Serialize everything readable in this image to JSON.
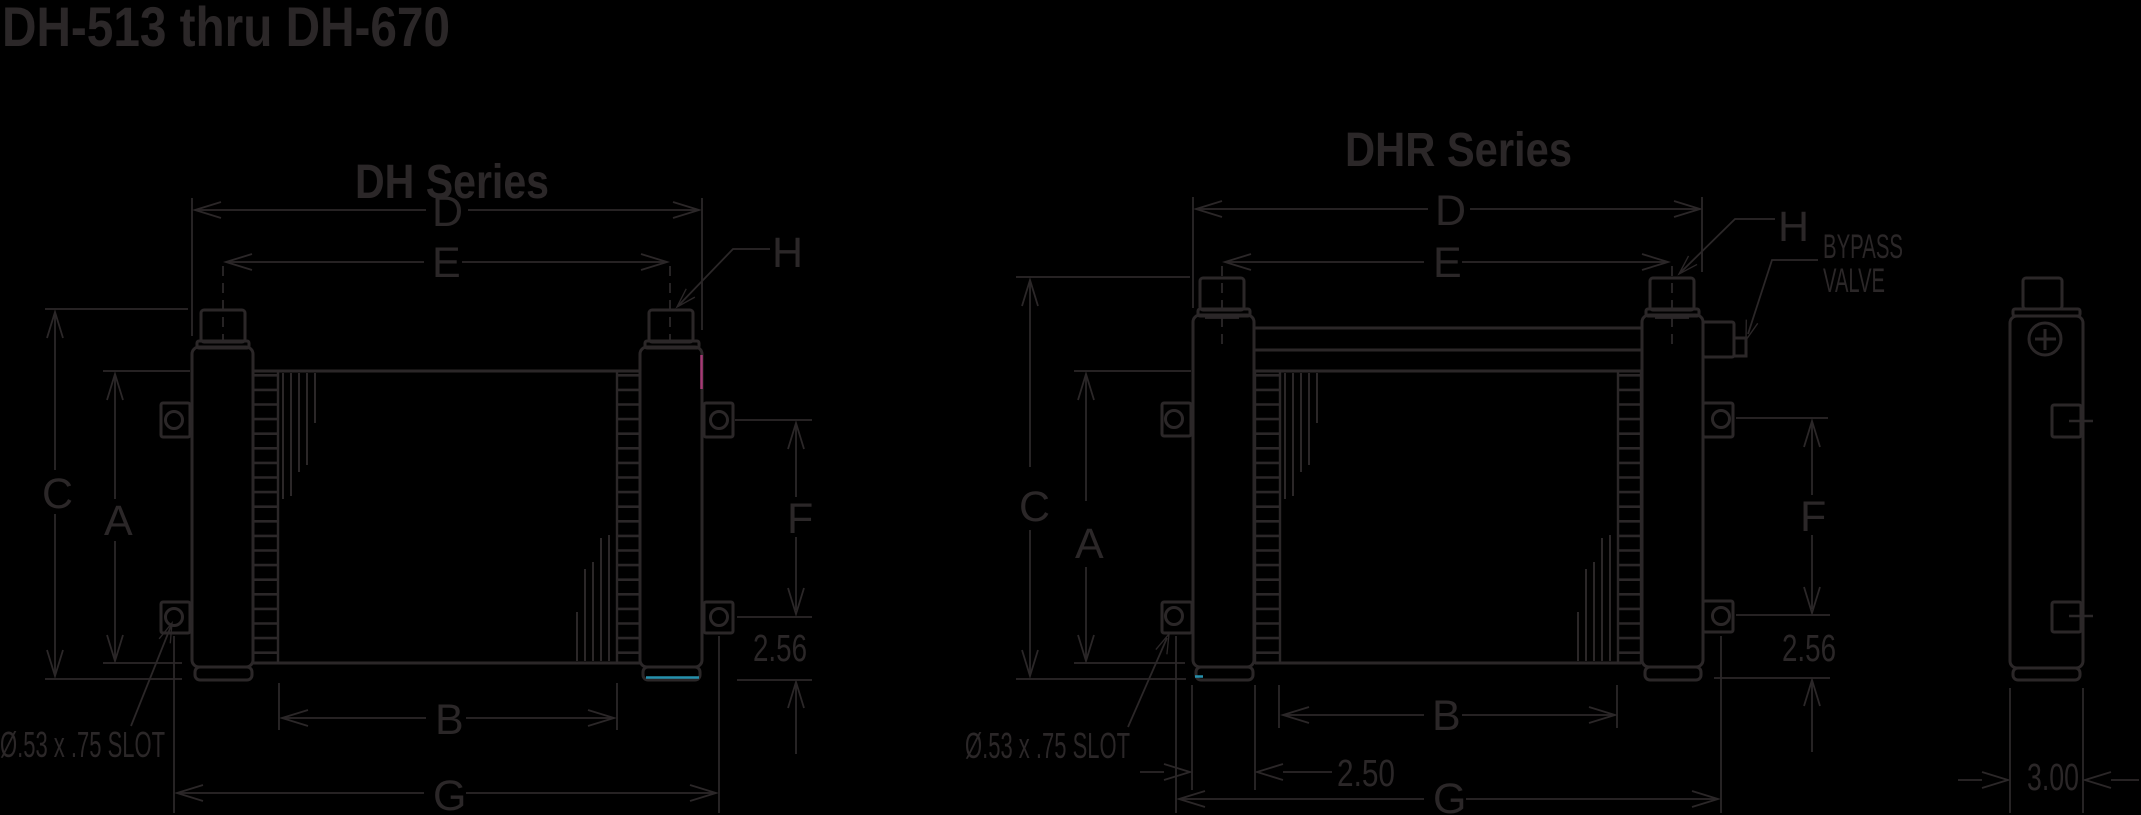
{
  "header": {
    "title": "DH-513 thru DH-670"
  },
  "dh_view": {
    "title": "DH Series",
    "labels": {
      "width_overall": "D",
      "width_ports": "E",
      "port": "H",
      "height_overall": "C",
      "height_core": "A",
      "bracket_span": "F",
      "bracket_offset": "2.56",
      "core_width": "B",
      "slot_span": "G",
      "slot_note": "Ø.53 x .75 SLOT"
    }
  },
  "dhr_view": {
    "title": "DHR Series",
    "labels": {
      "width_overall": "D",
      "width_ports": "E",
      "port": "H",
      "bypass_line1": "BYPASS",
      "bypass_line2": "VALVE",
      "height_overall": "C",
      "height_core": "A",
      "bracket_span": "F",
      "bracket_offset": "2.56",
      "core_width": "B",
      "tank_width": "2.50",
      "slot_span": "G",
      "slot_note": "Ø.53 x .75 SLOT"
    }
  },
  "side_view": {
    "depth": "3.00"
  },
  "colors": {
    "ink": "#2b2728",
    "accent_magenta": "#a53a75",
    "accent_cyan": "#2691ad",
    "background": "#000000"
  }
}
